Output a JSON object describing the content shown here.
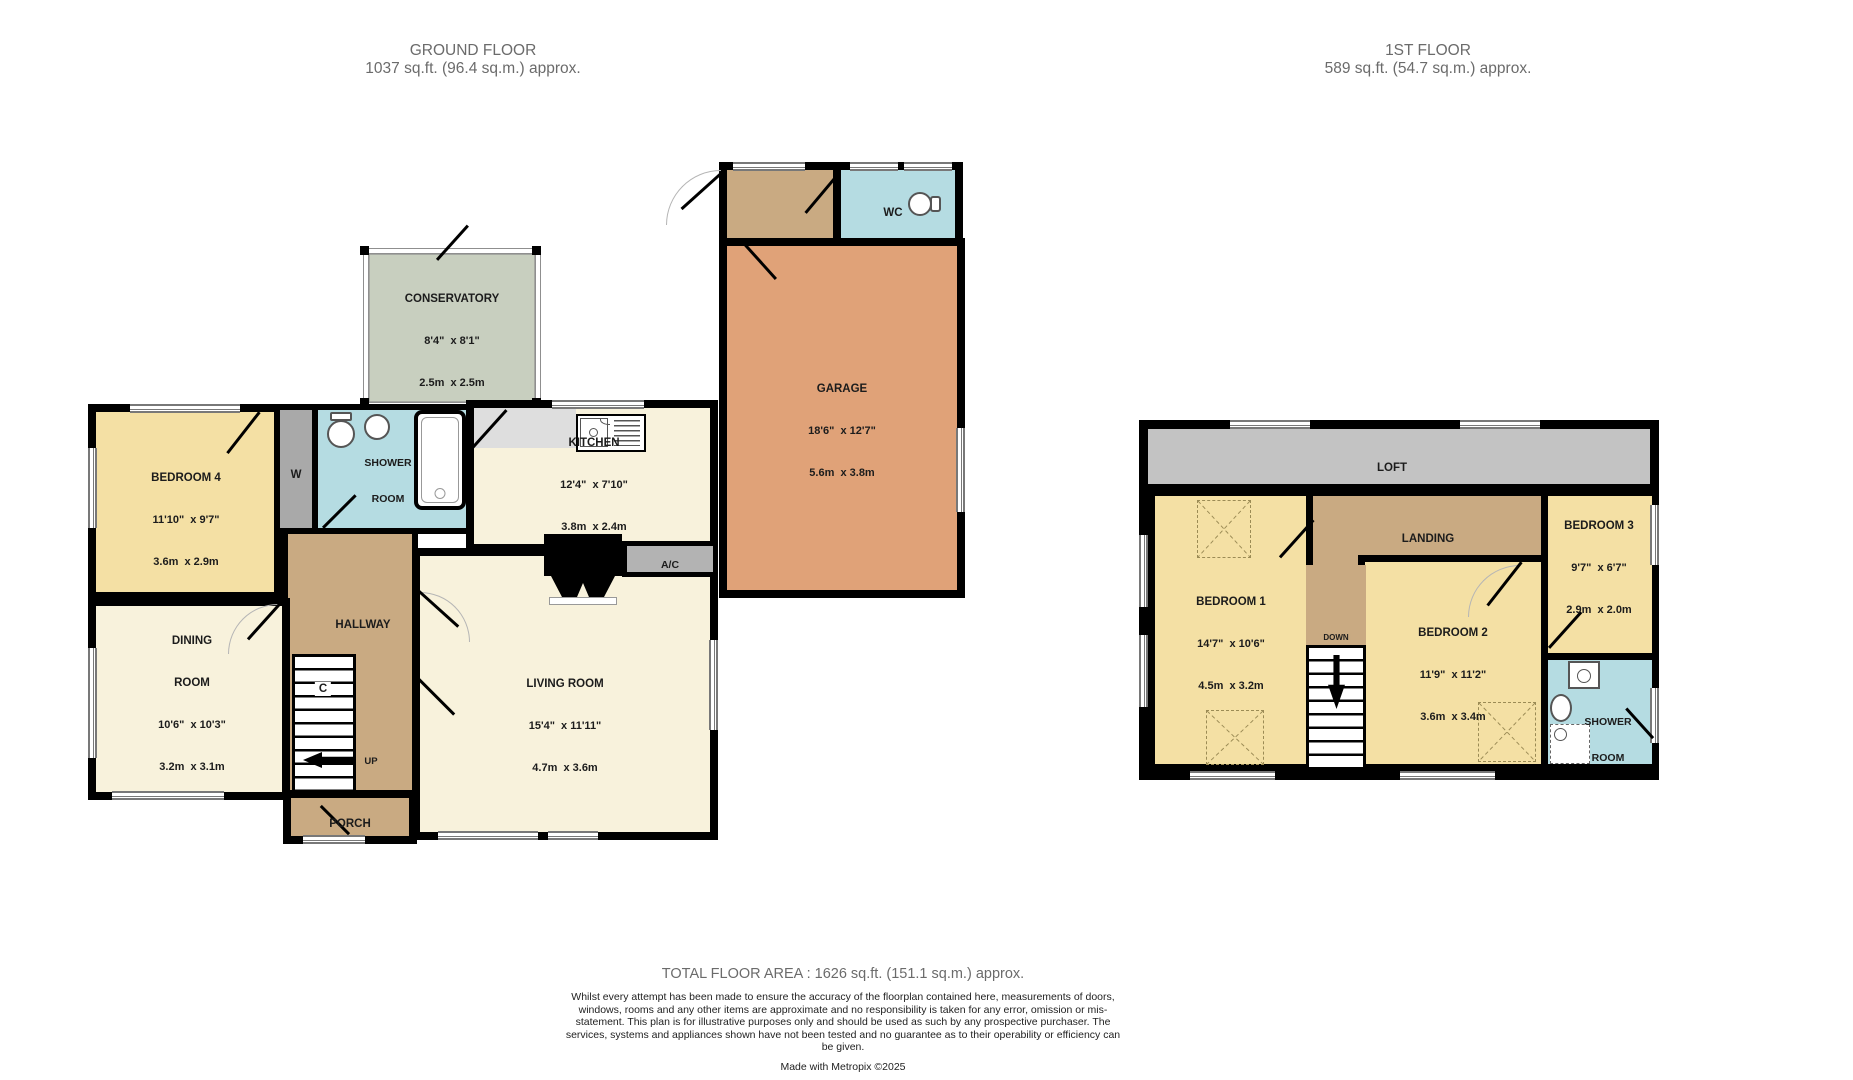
{
  "ground_floor": {
    "header_title": "GROUND FLOOR",
    "header_area": "1037 sq.ft. (96.4 sq.m.) approx.",
    "rooms": {
      "conservatory": {
        "name": "CONSERVATORY",
        "imperial": "8'4\"  x 8'1\"",
        "metric": "2.5m  x 2.5m"
      },
      "wc": {
        "name": "WC"
      },
      "garage": {
        "name": "GARAGE",
        "imperial": "18'6\"  x 12'7\"",
        "metric": "5.6m  x 3.8m"
      },
      "bedroom4": {
        "name": "BEDROOM 4",
        "imperial": "11'10\"  x 9'7\"",
        "metric": "3.6m  x 2.9m"
      },
      "wardrobe": {
        "name": "W"
      },
      "shower_room": {
        "line1": "SHOWER",
        "line2": "ROOM"
      },
      "kitchen": {
        "name": "KITCHEN",
        "imperial": "12'4\"  x 7'10\"",
        "metric": "3.8m  x 2.4m"
      },
      "ac": {
        "name": "A/C"
      },
      "hallway": {
        "name": "HALLWAY"
      },
      "stairs_cupboard": {
        "name": "C"
      },
      "stairs_up": {
        "name": "UP"
      },
      "dining": {
        "line1": "DINING",
        "line2": "ROOM",
        "imperial": "10'6\"  x 10'3\"",
        "metric": "3.2m  x 3.1m"
      },
      "living": {
        "name": "LIVING ROOM",
        "imperial": "15'4\"  x 11'11\"",
        "metric": "4.7m  x 3.6m"
      },
      "porch": {
        "name": "PORCH"
      }
    }
  },
  "first_floor": {
    "header_title": "1ST FLOOR",
    "header_area": "589 sq.ft. (54.7 sq.m.) approx.",
    "rooms": {
      "loft": {
        "name": "LOFT"
      },
      "landing": {
        "name": "LANDING"
      },
      "stairs_down": {
        "name": "DOWN"
      },
      "bedroom1": {
        "name": "BEDROOM 1",
        "imperial": "14'7\"  x 10'6\"",
        "metric": "4.5m  x 3.2m"
      },
      "bedroom2": {
        "name": "BEDROOM 2",
        "imperial": "11'9\"  x 11'2\"",
        "metric": "3.6m  x 3.4m"
      },
      "bedroom3": {
        "name": "BEDROOM 3",
        "imperial": "9'7\"  x 6'7\"",
        "metric": "2.9m  x 2.0m"
      },
      "shower_room": {
        "line1": "SHOWER",
        "line2": "ROOM"
      }
    }
  },
  "footer": {
    "total_area": "TOTAL FLOOR AREA : 1626 sq.ft. (151.1 sq.m.) approx.",
    "disclaimer": "Whilst every attempt has been made to ensure the accuracy of the floorplan contained here, measurements of doors, windows, rooms and any other items are approximate and no responsibility is taken for any error, omission or mis-statement. This plan is for illustrative purposes only and should be used as such by any prospective purchaser. The services, systems and appliances shown have not been tested and no guarantee as to their operability or efficiency can be given.",
    "credit": "Made with Metropix ©2025"
  },
  "colors": {
    "wall": "#000000",
    "bedroom_yellow": "#f4e0a4",
    "reception_cream": "#f8f2dc",
    "hall_tan": "#c9aa82",
    "wet_room_blue": "#b5dce2",
    "conservatory_green": "#c8cfbf",
    "garage_orange": "#e0a278",
    "loft_gray": "#c3c3c3",
    "fixture_gray": "#b3b3b3",
    "header_text": "#6b6b6b"
  }
}
